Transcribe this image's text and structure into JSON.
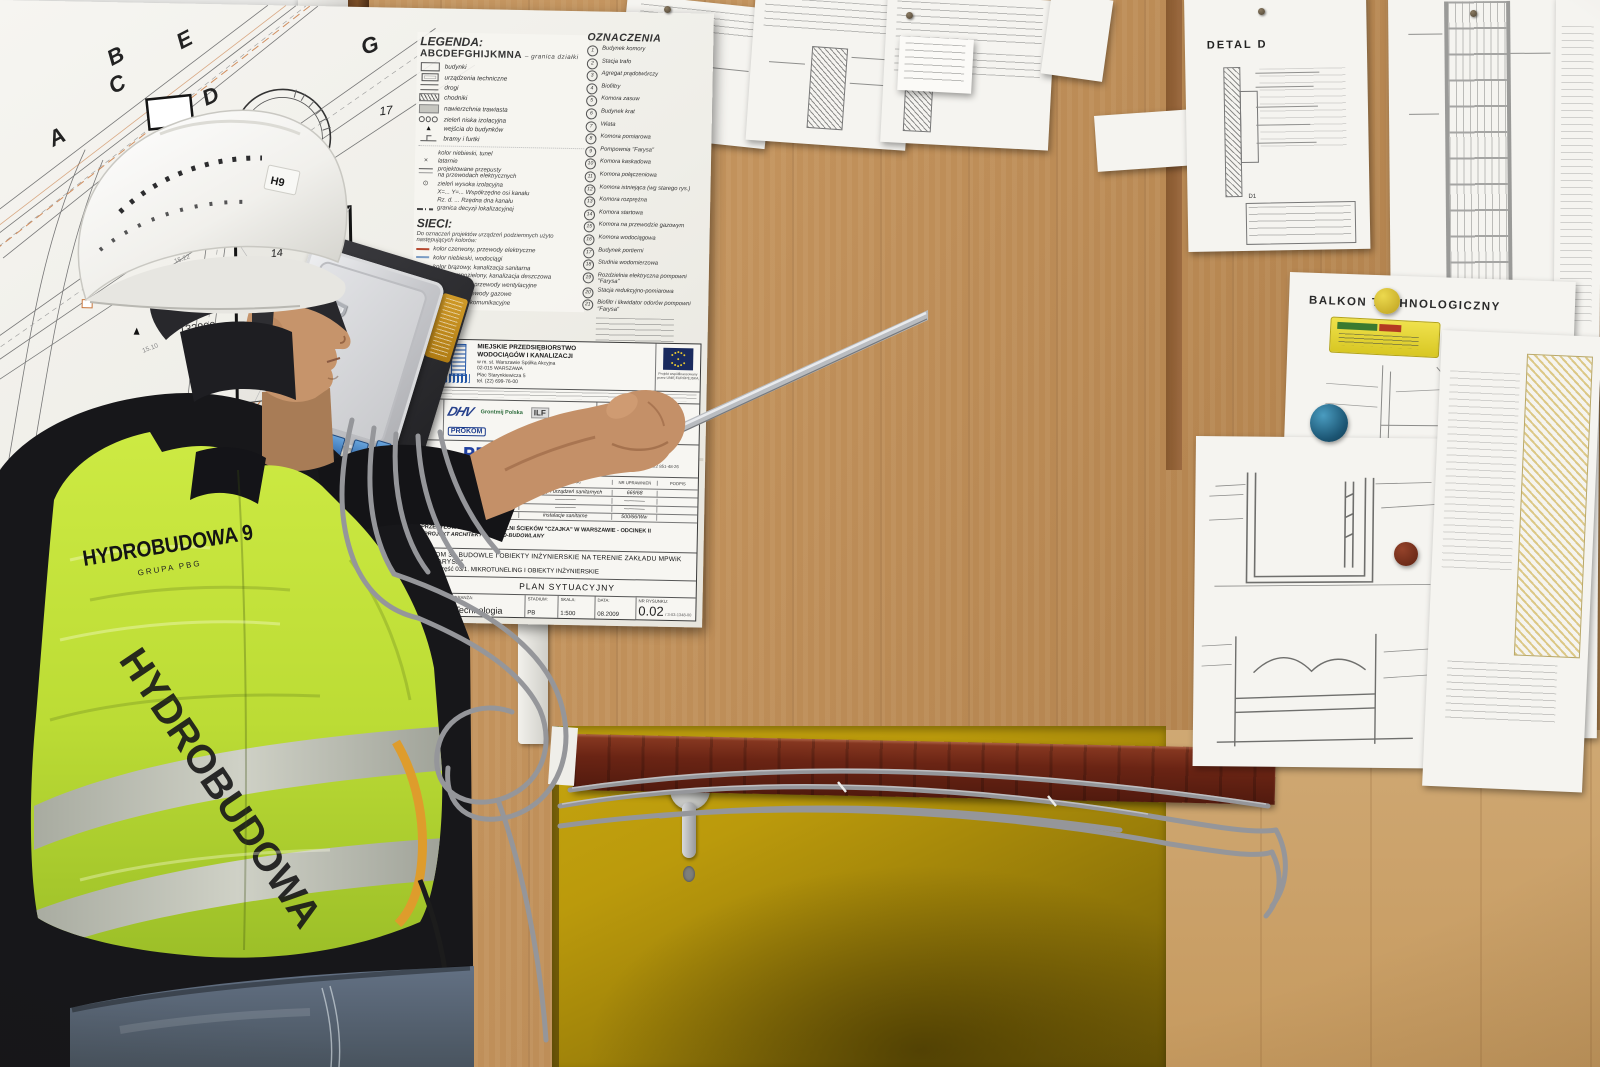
{
  "worker": {
    "helmet_sticker": "H9",
    "vest_brand": "HYDROBUDOWA 9",
    "vest_group": "GRUPA PBG",
    "vest_side_text": "HYDROBUDOWA"
  },
  "device": {
    "brand": "D-Link"
  },
  "papers": {
    "detal_title": "DETAL D",
    "detal_table": "D1",
    "balkon_title": "BALKON TECHNOLOGICZNY"
  },
  "plan": {
    "legend": {
      "title": "LEGENDA:",
      "alphabet": "ABCDEFGHIJKMNA",
      "alphabet_desc": "– granica działki",
      "items": [
        "budynki",
        "urządzenia techniczne",
        "drogi",
        "chodniki",
        "nawierzchnia trawiasta",
        "zieleń niska izolacyjna",
        "wejścia do budynków",
        "bramy i furtki"
      ],
      "extras": [
        "kolor niebieski, tunel",
        "latarnie",
        "projektowane przepusty\nna przewodach elektrycznych",
        "zieleń wysoka izolacyjna",
        "X=... Y=...  Współrzędne osi kanału",
        "Rz. d. ...  Rzędna dna kanału",
        "granica decyzji lokalizacyjnej"
      ]
    },
    "sieci": {
      "title": "SIECI:",
      "intro": "Do oznaczeń projektów urządzeń podziemnych użyto następujących kolorów:",
      "items": [
        "kolor czerwony, przewody elektryczne",
        "kolor niebieski, wodociągi",
        "kolor brązowy, kanalizacja sanitarna",
        "kolor ciemnozielony, kanalizacja deszczowa",
        "kolor fioletowy, przewody wentylacyjne",
        "kolor żółty, przewody gazowe",
        "przewody telekomunikacyjne"
      ],
      "colors": [
        "#b5482f",
        "#7a9cc4",
        "#96683a",
        "#4a6a4a",
        "#8a6a9a",
        "#c0a830",
        "#555555"
      ]
    },
    "oznaczenia": {
      "title": "OZNACZENIA",
      "items": [
        {
          "n": "1",
          "label": "Budynek komory"
        },
        {
          "n": "2",
          "label": "Stacja trafo"
        },
        {
          "n": "3",
          "label": "Agregat prądotwórczy"
        },
        {
          "n": "4",
          "label": "Biofiltry"
        },
        {
          "n": "5",
          "label": "Komora zasuw"
        },
        {
          "n": "6",
          "label": "Budynek krat"
        },
        {
          "n": "7",
          "label": "Wiata"
        },
        {
          "n": "8",
          "label": "Komora pomiarowa"
        },
        {
          "n": "9",
          "label": "Pompownia \"Farysa\""
        },
        {
          "n": "10",
          "label": "Komora kaskadowa"
        },
        {
          "n": "11",
          "label": "Komora połączeniowa"
        },
        {
          "n": "12",
          "label": "Komora istniejąca (wg starego rys.)"
        },
        {
          "n": "13",
          "label": "Komora rozprężna"
        },
        {
          "n": "14",
          "label": "Komora startowa"
        },
        {
          "n": "15",
          "label": "Komora na przewodzie gazowym"
        },
        {
          "n": "16",
          "label": "Komora wodociągowa"
        },
        {
          "n": "17",
          "label": "Budynek portierni"
        },
        {
          "n": "18",
          "label": "Studnia wodomierzowa"
        },
        {
          "n": "19",
          "label": "Rozdzielnia elektryczna pompowni \"Farysa\""
        },
        {
          "n": "20",
          "label": "Stacja redukcyjno-pomiarowa"
        },
        {
          "n": "21",
          "label": "Biofiltr i likwidator odorów pompowni \"Farysa\""
        }
      ]
    },
    "map": {
      "letters": {
        "a": "A",
        "b": "B",
        "c": "C",
        "d": "D",
        "e": "E",
        "g": "G",
        "n": "N"
      },
      "numbers": {
        "s1": "1",
        "s3": "3",
        "s5": "5",
        "s6": "6",
        "s13": "13",
        "s14": "14",
        "s17": "17",
        "s18": "18"
      },
      "site_label1": "Zakład MPWiK",
      "site_label2": "\"Farysa\"",
      "dim_label": "132800",
      "pipe_note": "Ø300, L=58 m",
      "elevations": [
        "14.97",
        "15.22",
        "14.64",
        "15.48",
        "15.10",
        "14.87"
      ]
    },
    "title_block": {
      "zamawiajacy_label": "ZAMAWIAJĄCY:",
      "client_line1": "MIEJSKIE PRZEDSIĘBIORSTWO",
      "client_line2": "WODOCIĄGÓW I KANALIZACJI",
      "client_line3": "w m. st. Warszawie Spółka Akcyjna",
      "client_line4": "02-015 WARSZAWA",
      "client_line5": "Plac Starynkiewicza 5",
      "client_line6": "tel. (22) 699-76-00",
      "eu_note1": "Projekt współfinansowany",
      "eu_note2": "przez UNIĘ EUROPEJSKĄ",
      "wykonawca_label": "WYKONAWCA KONSORCJUM FPM",
      "logo_dhv": "DHV",
      "logo_grontmij": "Grontmij Polska",
      "logo_ilf": "ILF",
      "logo_prokom_small": "PROKOM",
      "lider_label": "LIDER KONSORCJUM",
      "lider_name": "DHV POLSKA Sp. z o.o.",
      "lider_addr1": "ul. Domaniewska 41",
      "lider_addr2": "02-672 Warszawa",
      "lider_addr3": "tel. (22) 606 28 02, fax (22) 606 28 03",
      "lider_addr4": "e-mail: dhvpolska@dhv.pl",
      "biuro_label": "BIURO PROJEKTOWE",
      "prokom_logo": "PROKOM",
      "prokom_reg": "®",
      "prokom_sub": "Spółka z o.o.",
      "prokom_founded": "Rok założenia 1987",
      "biuro_name": "PROKOM Sp. z o.o.",
      "biuro_addr1": "00-718 Warszawa ul. Czerniakowska 71",
      "biuro_addr2": "tel. 022 851-43-12, 022 851-43-13, fax. 022 851-48-26",
      "th_funkcja": "FUNKCJA",
      "th_name": "IMIĘ I NAZWISKO",
      "th_spec": "SPECJALNOŚĆ",
      "th_upr": "NR UPRAWNIEŃ",
      "th_podpis": "PODPIS",
      "rows": [
        {
          "f": "Projektant:",
          "n": "inż. Andrzej Zgoła",
          "s": "instalacji i urządzeń sanitarnych",
          "u": "669/68"
        },
        {
          "f": "Opracował:",
          "n": "mgr inż. Wojciech Sławiński",
          "s": "————",
          "u": "————"
        },
        {
          "f": "",
          "n": "mgr inż. Maciej Urbanek",
          "s": "————",
          "u": "————"
        },
        {
          "f": "Sprawdził:",
          "n": "mgr inż. Zbigniew Szepietowski",
          "s": "instalacje sanitarne",
          "u": "500/66/Ww"
        }
      ],
      "obiekt_label": "Nazwa i adres obiektu budowlanego:",
      "obiekt_value": "UKŁAD PRZESYŁOWY DO OCZYSZCZALNI ŚCIEKÓW \"CZAJKA\" W WARSZAWIE - ODCINEK II",
      "stadium_label": "Stadium:",
      "stadium_value": "PROJEKT ARCHITEKTONICZNO-BUDOWLANY",
      "tom_label": "Nazwa tomu:",
      "tom_value": "TOM 3 - BUDOWLE I OBIEKTY INŻYNIERSKIE NA TERENIE ZAKŁADU MPWiK \"FARYSA\"",
      "czesc_label": "Nazwa części:",
      "czesc_value": "Część 03/1. MIKROTUNELING I OBIEKTY INŻYNIERSKIE",
      "rysunek_label": "Nazwa rysunku:",
      "rysunek_value": "PLAN SYTUACYJNY",
      "umowa_label": "Nr umowy:",
      "umowa_value": "10/JRP/U/2008",
      "branza_label": "Branża:",
      "branza_value": "Technologia",
      "stadium2_label": "Stadium:",
      "stadium2_value": "PB",
      "skala_label": "Skala:",
      "skala_value": "1:500",
      "data_label": "Data:",
      "data_value": "08.2009",
      "nr_label": "Nr rysunku:",
      "nr_value": "0.02",
      "nr_code": "/ 3-03-1348-00"
    }
  }
}
